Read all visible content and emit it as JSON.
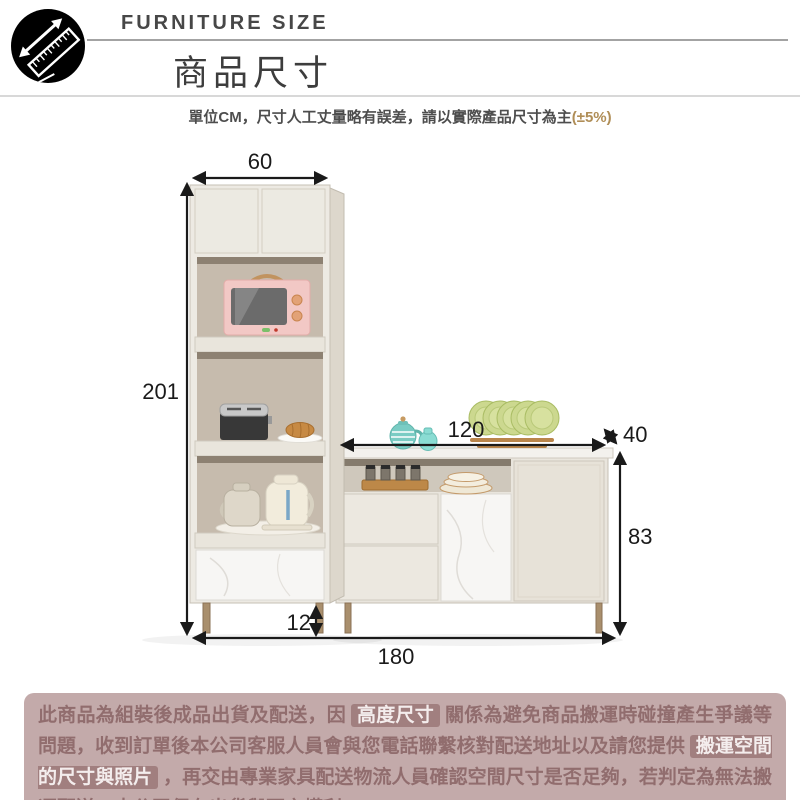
{
  "header": {
    "eyebrow": "FURNITURE SIZE",
    "title": "商品尺寸",
    "note_text": "單位CM，尺寸人工丈量略有誤差，請以實際產品尺寸為主",
    "note_tolerance": "(±5%)"
  },
  "diagram": {
    "dims": {
      "tall_cabinet_width": "60",
      "tall_cabinet_height": "201",
      "sideboard_top_width": "120",
      "sideboard_depth": "40",
      "sideboard_height": "83",
      "leg_height": "12",
      "total_width": "180"
    }
  },
  "notice": {
    "segments": [
      {
        "text": "此商品為組裝後成品出貨及配送，因",
        "highlight": false
      },
      {
        "text": "高度尺寸",
        "highlight": true
      },
      {
        "text": "關係為避免商品搬運時碰撞產生爭議等問題，收到訂單後本公司客服人員會與您電話聯繫核對配送地址以及請您提供",
        "highlight": false
      },
      {
        "text": "搬運空間的尺寸與照片",
        "highlight": true
      },
      {
        "text": "，再交由專業家具配送物流人員確認空間尺寸是否足夠，若判定為無法搬運配送，本公司保有出貨與否之權利。",
        "highlight": false
      }
    ]
  },
  "colors": {
    "tolerance_text": "#b08e57",
    "dimension_lines": "#1a1a1a",
    "notice_background": "#c3aaaa",
    "notice_text": "#916d6e",
    "notice_highlight_background": "#a17f7f",
    "notice_highlight_text": "#f4eded"
  }
}
